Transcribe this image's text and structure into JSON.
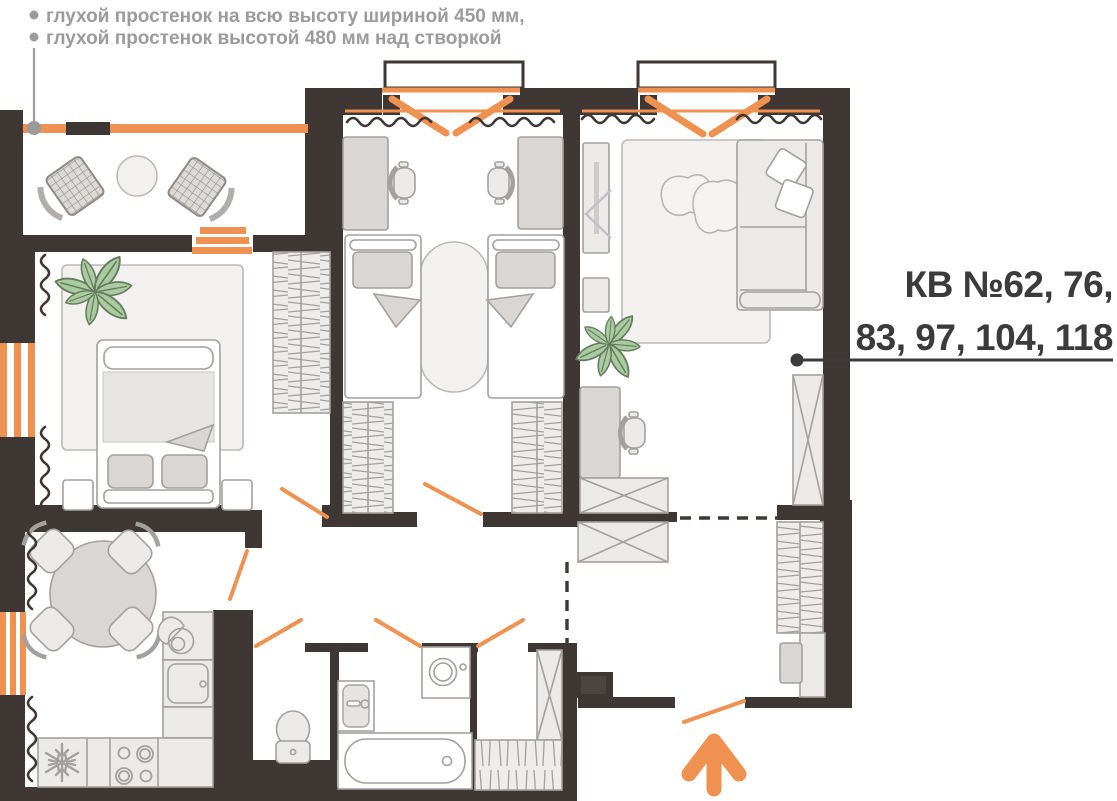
{
  "annotations": {
    "notes": [
      "глухой простенок на всю высоту шириной 450 мм,",
      "глухой простенок высотой 480 мм над створкой"
    ],
    "apartment_label": {
      "line1": "КВ №62, 76,",
      "line2": "83, 97, 104, 118"
    }
  },
  "symbols": {
    "entrance": "arrow-up-icon",
    "fridge": "snowflake-icon",
    "stove": "burners-icon",
    "wardrobe_hatch": "hanging-rail-hatch",
    "storage_x": "crossed-box",
    "window_note_marker": "dot-leader",
    "apartment_leader": "dot-leader"
  },
  "colors": {
    "wall": "#3E3733",
    "accent": "#EF9150",
    "furniture_stroke": "#A3A09D",
    "furniture_fill": "#EBEAE8",
    "furniture_medium": "#D9D6D3",
    "rug": "#F2F1EF",
    "plant_fill": "#A9CBA0",
    "plant_stroke": "#647B5D",
    "note_text": "#9B9B9B",
    "title_text": "#3B3B3B",
    "background": "#FFFFFF"
  }
}
